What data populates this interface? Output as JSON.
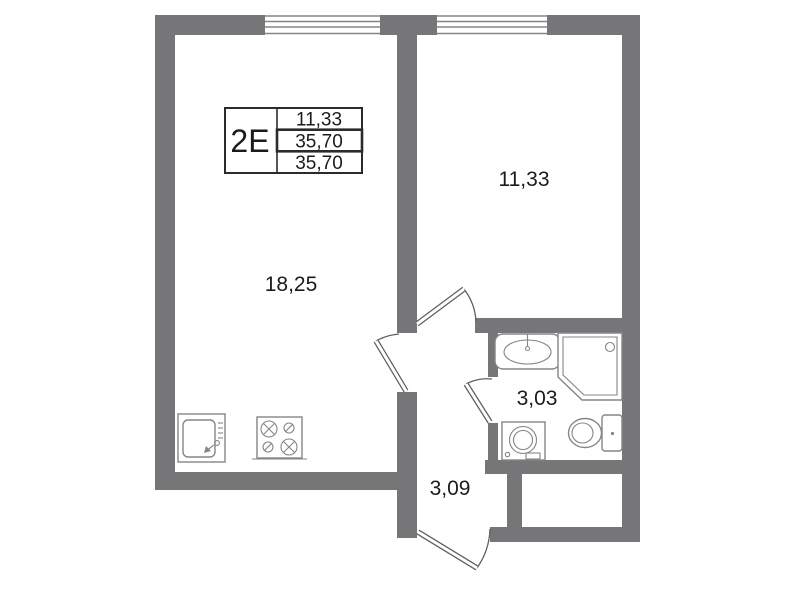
{
  "legend": {
    "type": "2E",
    "values": [
      "11,33",
      "35,70",
      "35,70"
    ]
  },
  "rooms": {
    "living_kitchen": {
      "area": "18,25"
    },
    "bedroom": {
      "area": "11,33"
    },
    "bathroom": {
      "area": "3,03"
    },
    "hallway": {
      "area": "3,09"
    }
  },
  "fixtures": [
    "kitchen-sink",
    "stove",
    "bathroom-sink",
    "shower-cabin",
    "washing-machine",
    "toilet"
  ],
  "colors": {
    "wall": "#767678",
    "outline": "#85858a",
    "door": "#5f5f5f",
    "text": "#1b1b1b",
    "table": "#2b2b2b"
  }
}
